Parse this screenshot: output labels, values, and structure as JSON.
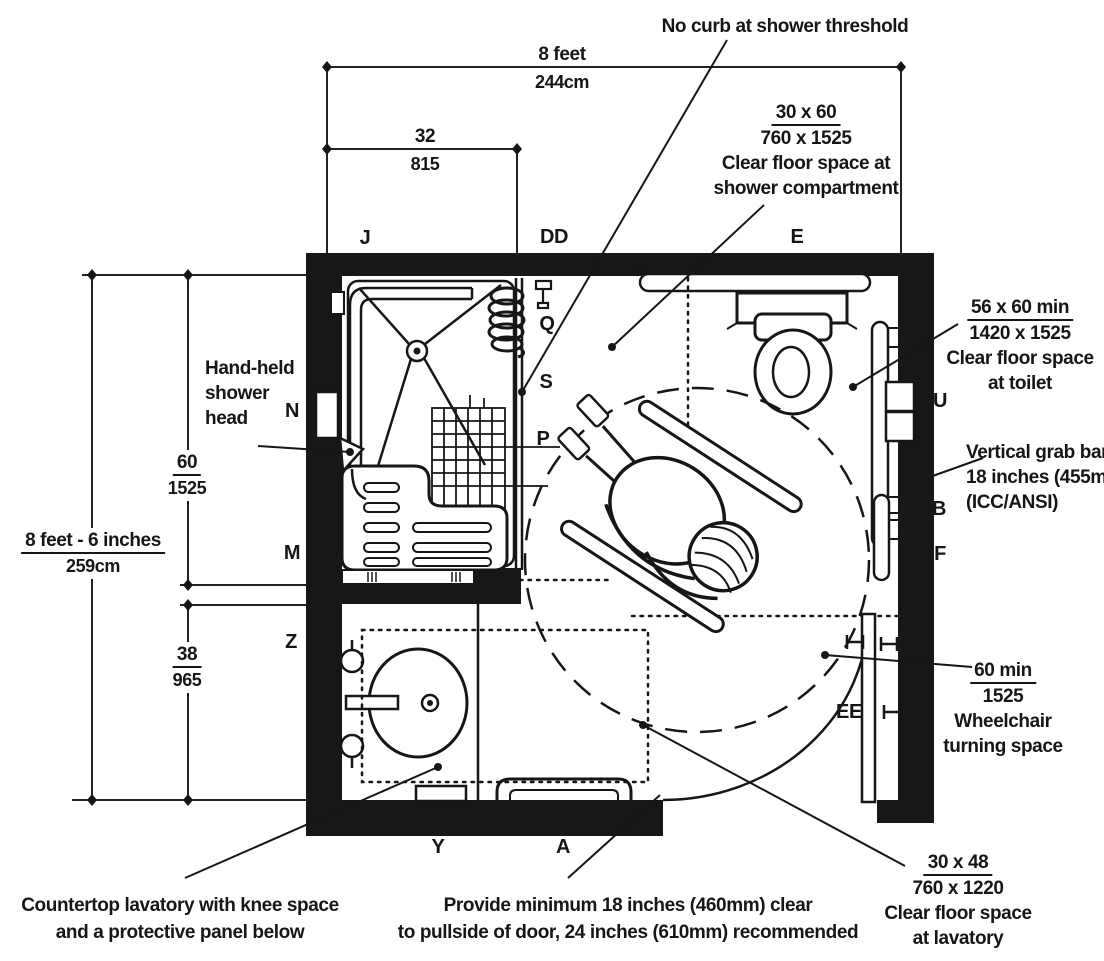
{
  "colors": {
    "ink": "#161616",
    "paper": "#ffffff"
  },
  "dimensions": {
    "room_width_primary": "8 feet",
    "room_width_secondary": "244cm",
    "shower_width_primary": "32",
    "shower_width_secondary": "815",
    "room_depth_primary": "8 feet - 6 inches",
    "room_depth_secondary": "259cm",
    "shower_depth_primary": "60",
    "shower_depth_secondary": "1525",
    "vanity_depth_primary": "38",
    "vanity_depth_secondary": "965"
  },
  "annotations": {
    "no_curb": "No curb at shower threshold",
    "shower_clear_1": "30 x 60",
    "shower_clear_2": "760 x 1525",
    "shower_clear_3": "Clear floor space at",
    "shower_clear_4": "shower compartment",
    "toilet_clear_1": "56 x 60 min",
    "toilet_clear_2": "1420 x 1525",
    "toilet_clear_3": "Clear floor space",
    "toilet_clear_4": "at toilet",
    "grab_bar_1": "Vertical grab bar",
    "grab_bar_2": "18 inches (455mm)",
    "grab_bar_3": "(ICC/ANSI)",
    "turning_1": "60 min",
    "turning_2": "1525",
    "turning_3": "Wheelchair",
    "turning_4": "turning space",
    "lavatory_clear_1": "30 x 48",
    "lavatory_clear_2": "760 x 1220",
    "lavatory_clear_3": "Clear floor space",
    "lavatory_clear_4": "at lavatory",
    "hand_shower_1": "Hand-held",
    "hand_shower_2": "shower",
    "hand_shower_3": "head",
    "countertop_1": "Countertop lavatory with knee space",
    "countertop_2": "and a protective panel below",
    "door_1": "Provide minimum 18 inches (460mm) clear",
    "door_2": "to pullside of door, 24 inches (610mm) recommended"
  },
  "key_labels": {
    "j": "J",
    "dd": "DD",
    "e": "E",
    "q": "Q",
    "s": "S",
    "p": "P",
    "n": "N",
    "m": "M",
    "z": "Z",
    "y": "Y",
    "a": "A",
    "u": "U",
    "b": "B",
    "f": "F",
    "ee": "EE"
  }
}
